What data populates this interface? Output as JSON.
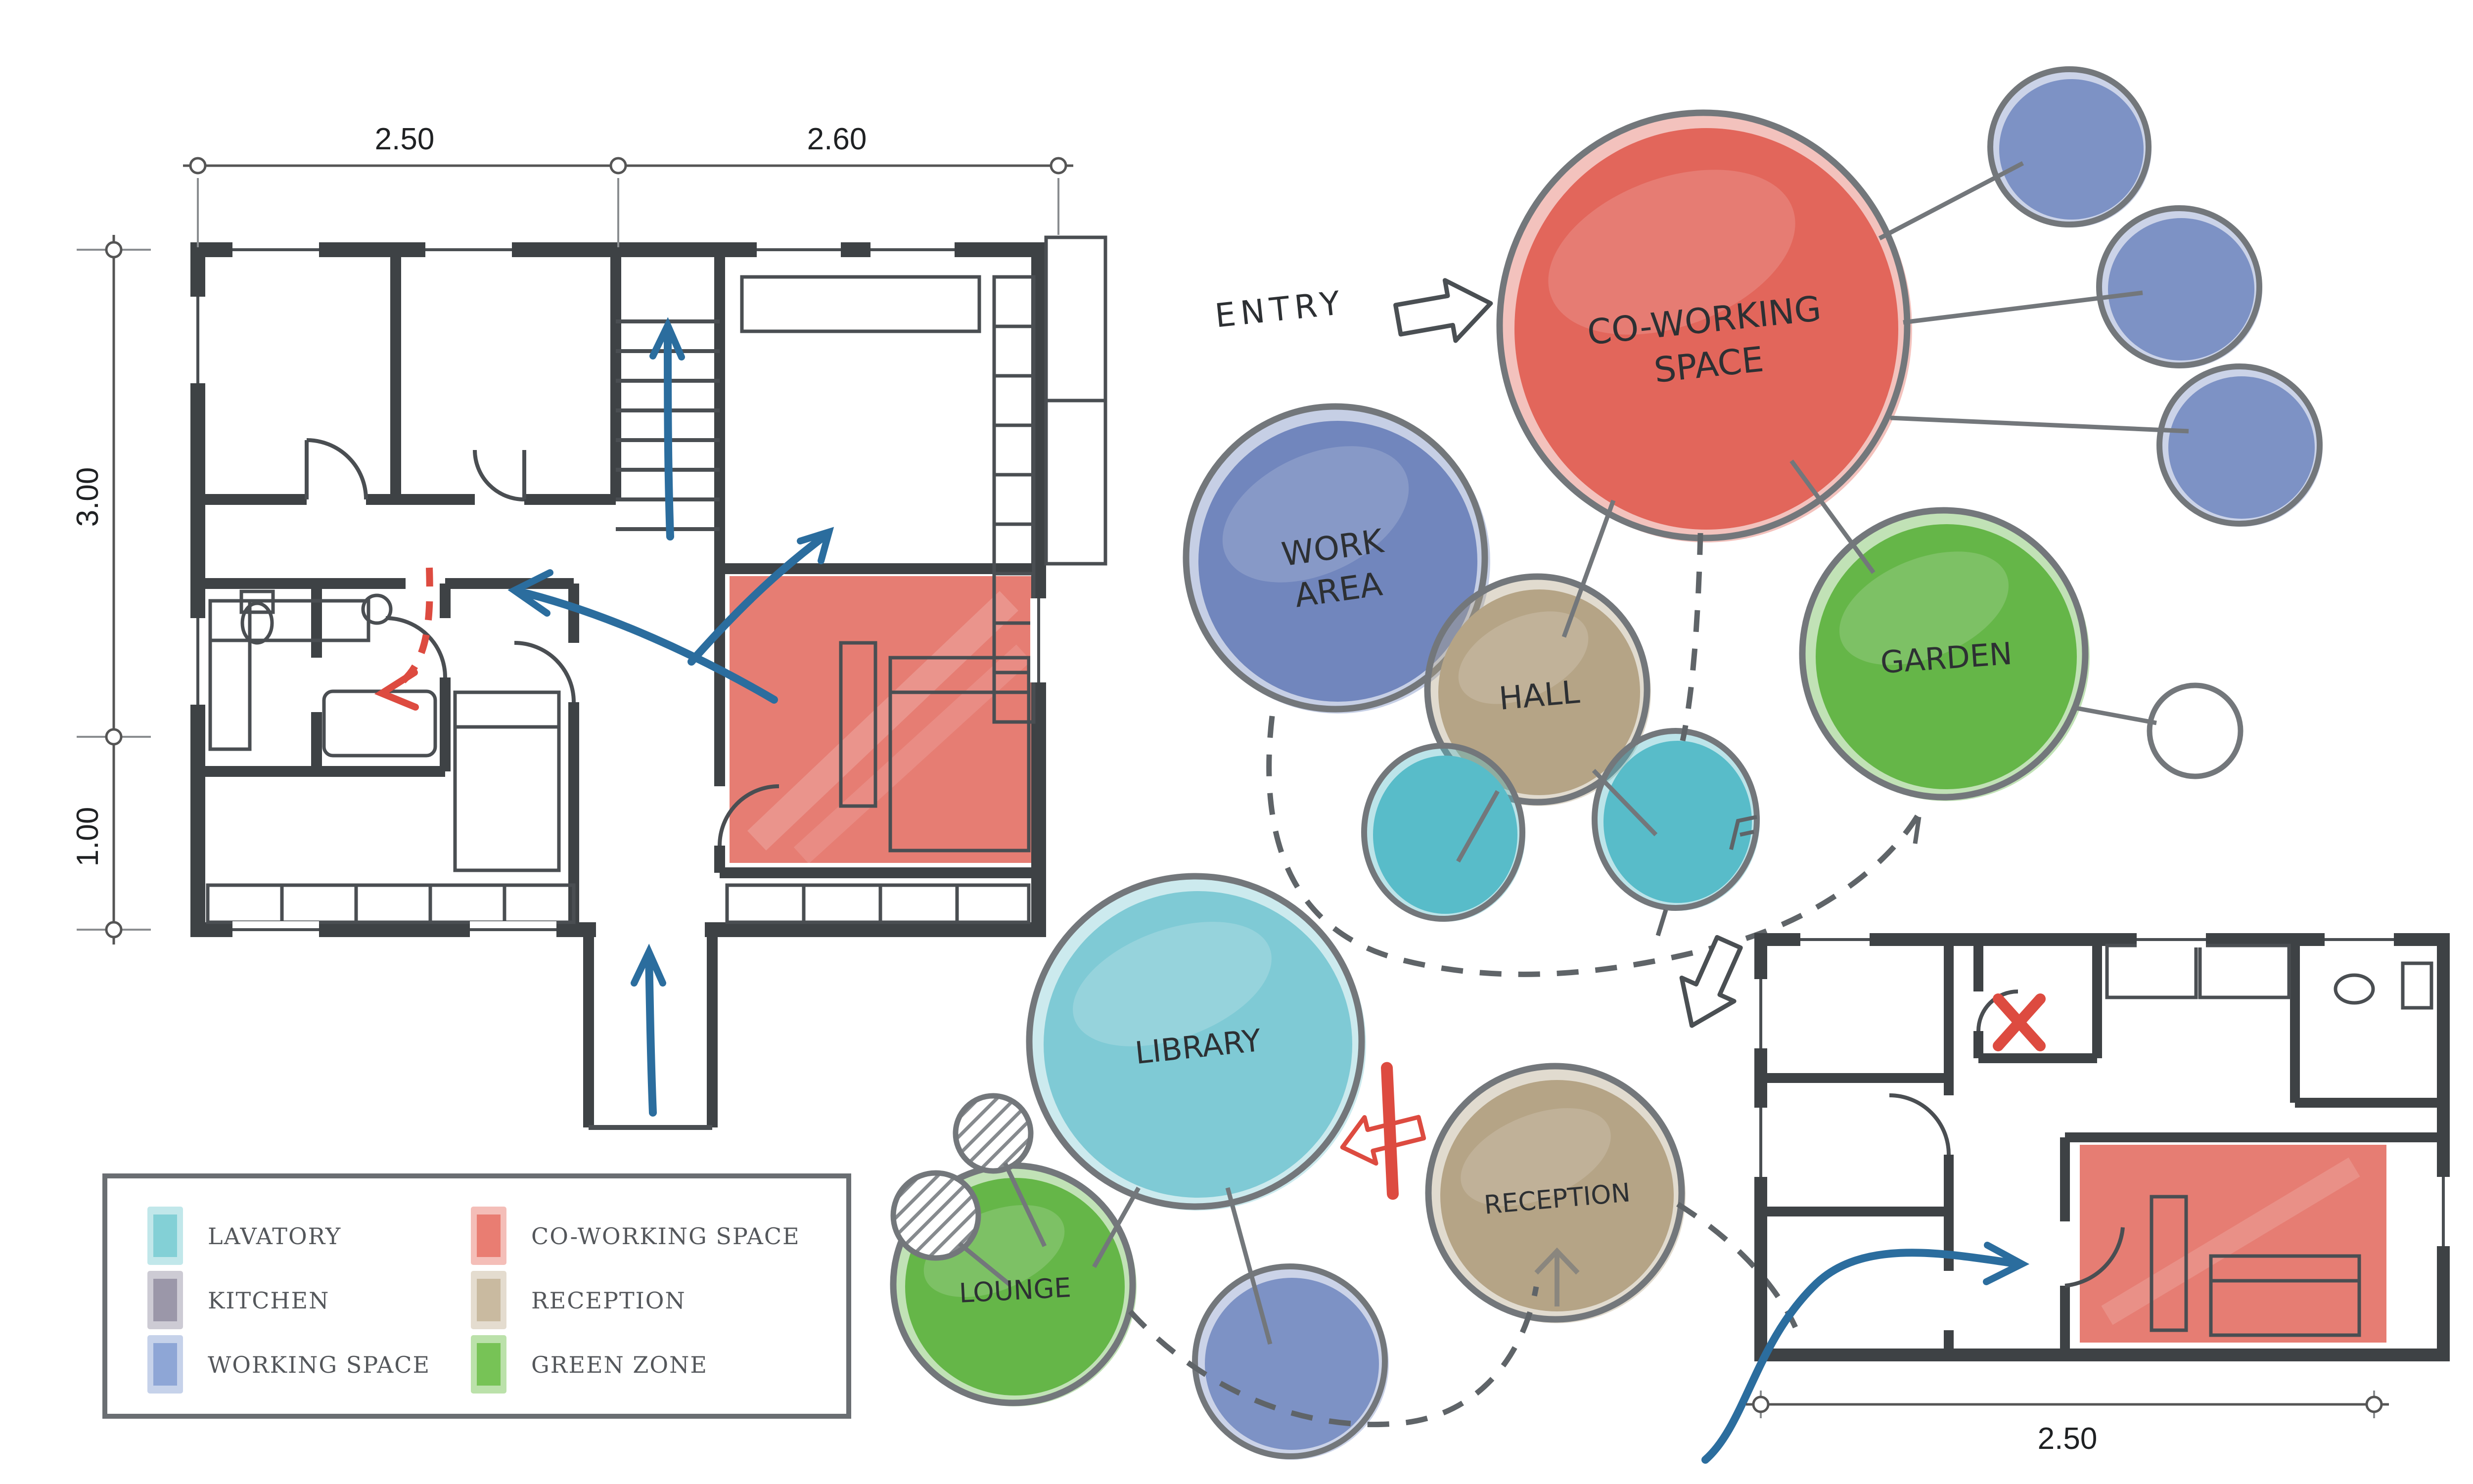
{
  "diagram": {
    "type": "architectural concept bubble diagram",
    "style": "hand-drawn watercolor"
  },
  "entry": {
    "label": "ENTRY"
  },
  "bubbles": [
    {
      "id": "co-working-space",
      "label": "CO-WORKING SPACE",
      "lines": [
        "CO-WORKING",
        "SPACE"
      ],
      "color": "#e2665b"
    },
    {
      "id": "work-area",
      "label": "WORK AREA",
      "lines": [
        "WORK",
        "AREA"
      ],
      "color": "#7186bd"
    },
    {
      "id": "hall",
      "label": "HALL",
      "lines": [
        "HALL"
      ],
      "color": "#b5a486"
    },
    {
      "id": "garden",
      "label": "GARDEN",
      "lines": [
        "GARDEN"
      ],
      "color": "#65b648"
    },
    {
      "id": "library",
      "label": "LIBRARY",
      "lines": [
        "LIBRARY"
      ],
      "color": "#7fcad5"
    },
    {
      "id": "lounge",
      "label": "LOUNGE",
      "lines": [
        "LOUNGE"
      ],
      "color": "#65b648"
    },
    {
      "id": "reception",
      "label": "RECEPTION",
      "lines": [
        "RECEPTION"
      ],
      "color": "#b5a486"
    }
  ],
  "satellites": {
    "working_space_color": "#7d92c5",
    "lavatory_color": "#58bcc9",
    "blue_circle_count": 4,
    "lavatory_circle_count": 2,
    "hatched_circle_count": 3
  },
  "legend": {
    "items": [
      {
        "label": "LAVATORY",
        "color": "#83d0d6"
      },
      {
        "label": "KITCHEN",
        "color": "#9b97a9"
      },
      {
        "label": "WORKING SPACE",
        "color": "#8ea6d6"
      },
      {
        "label": "CO-WORKING SPACE",
        "color": "#e97d72"
      },
      {
        "label": "RECEPTION",
        "color": "#c9baa0"
      },
      {
        "label": "GREEN ZONE",
        "color": "#77c356"
      }
    ]
  },
  "floor_plans": {
    "main": {
      "dims_top": [
        "2.50",
        "2.60"
      ],
      "dims_side": [
        "3.00",
        "1.00"
      ],
      "highlight_color": "#e2665b"
    },
    "small": {
      "dim_bottom": "2.50",
      "highlight_color": "#e2665b"
    }
  },
  "annotation_colors": {
    "flow_arrow": "#2b6d9e",
    "blocked": "#dd4b40",
    "outline": "#73777b",
    "wall": "#3e4245"
  }
}
